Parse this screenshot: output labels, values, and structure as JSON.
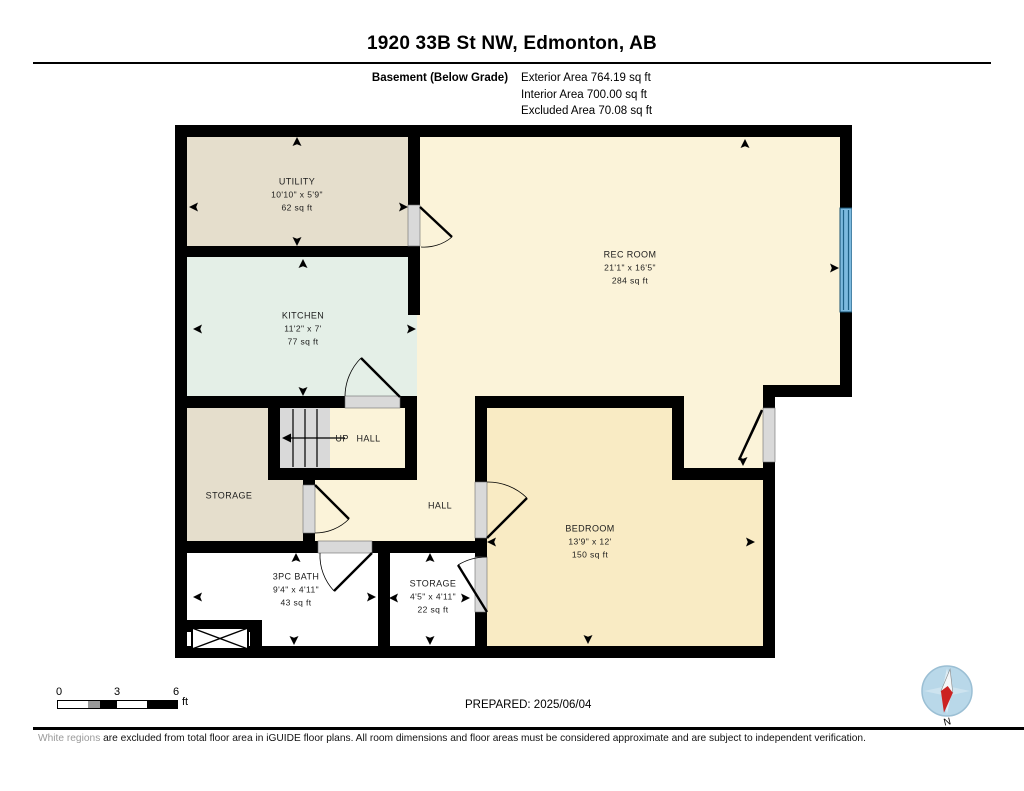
{
  "header": {
    "title": "1920 33B St NW, Edmonton, AB",
    "floor_label": "Basement (Below Grade)",
    "areas": [
      "Exterior Area 764.19 sq ft",
      "Interior Area 700.00 sq ft",
      "Excluded Area 70.08 sq ft"
    ]
  },
  "rooms": {
    "utility": {
      "name": "UTILITY",
      "dims": "10'10\" x 5'9\"",
      "area": "62 sq ft"
    },
    "kitchen": {
      "name": "KITCHEN",
      "dims": "11'2\" x 7'",
      "area": "77 sq ft"
    },
    "rec_room": {
      "name": "REC ROOM",
      "dims": "21'1\" x 16'5\"",
      "area": "284 sq ft"
    },
    "up_hall": {
      "name": "UP HALL"
    },
    "storage_upper": {
      "name": "STORAGE"
    },
    "hall": {
      "name": "HALL"
    },
    "bedroom": {
      "name": "BEDROOM",
      "dims": "13'9\" x 12'",
      "area": "150 sq ft"
    },
    "bath": {
      "name": "3PC BATH",
      "dims": "9'4\" x 4'11\"",
      "area": "43 sq ft"
    },
    "storage_lower": {
      "name": "STORAGE",
      "dims": "4'5\" x 4'11\"",
      "area": "22 sq ft"
    }
  },
  "scale_bar": {
    "ticks": [
      "0",
      "3",
      "6"
    ],
    "unit": "ft"
  },
  "prepared": "PREPARED: 2025/06/04",
  "compass": {
    "label": "N"
  },
  "footer": {
    "disclaimer_highlight": "White regions",
    "disclaimer_rest": " are excluded from total floor area in iGUIDE floor plans. All room dimensions and floor areas must be considered approximate and are subject to independent verification."
  },
  "colors": {
    "wall": "#000000",
    "cream_room": "#fbf3d9",
    "bedroom_wheat": "#f9ebc4",
    "beige_room": "#e5decc",
    "kitchen_mint": "#e4efe7",
    "excluded_white": "#ffffff",
    "window_blue": "#7cbadf",
    "door_sill_gray": "#d9d9d9"
  }
}
